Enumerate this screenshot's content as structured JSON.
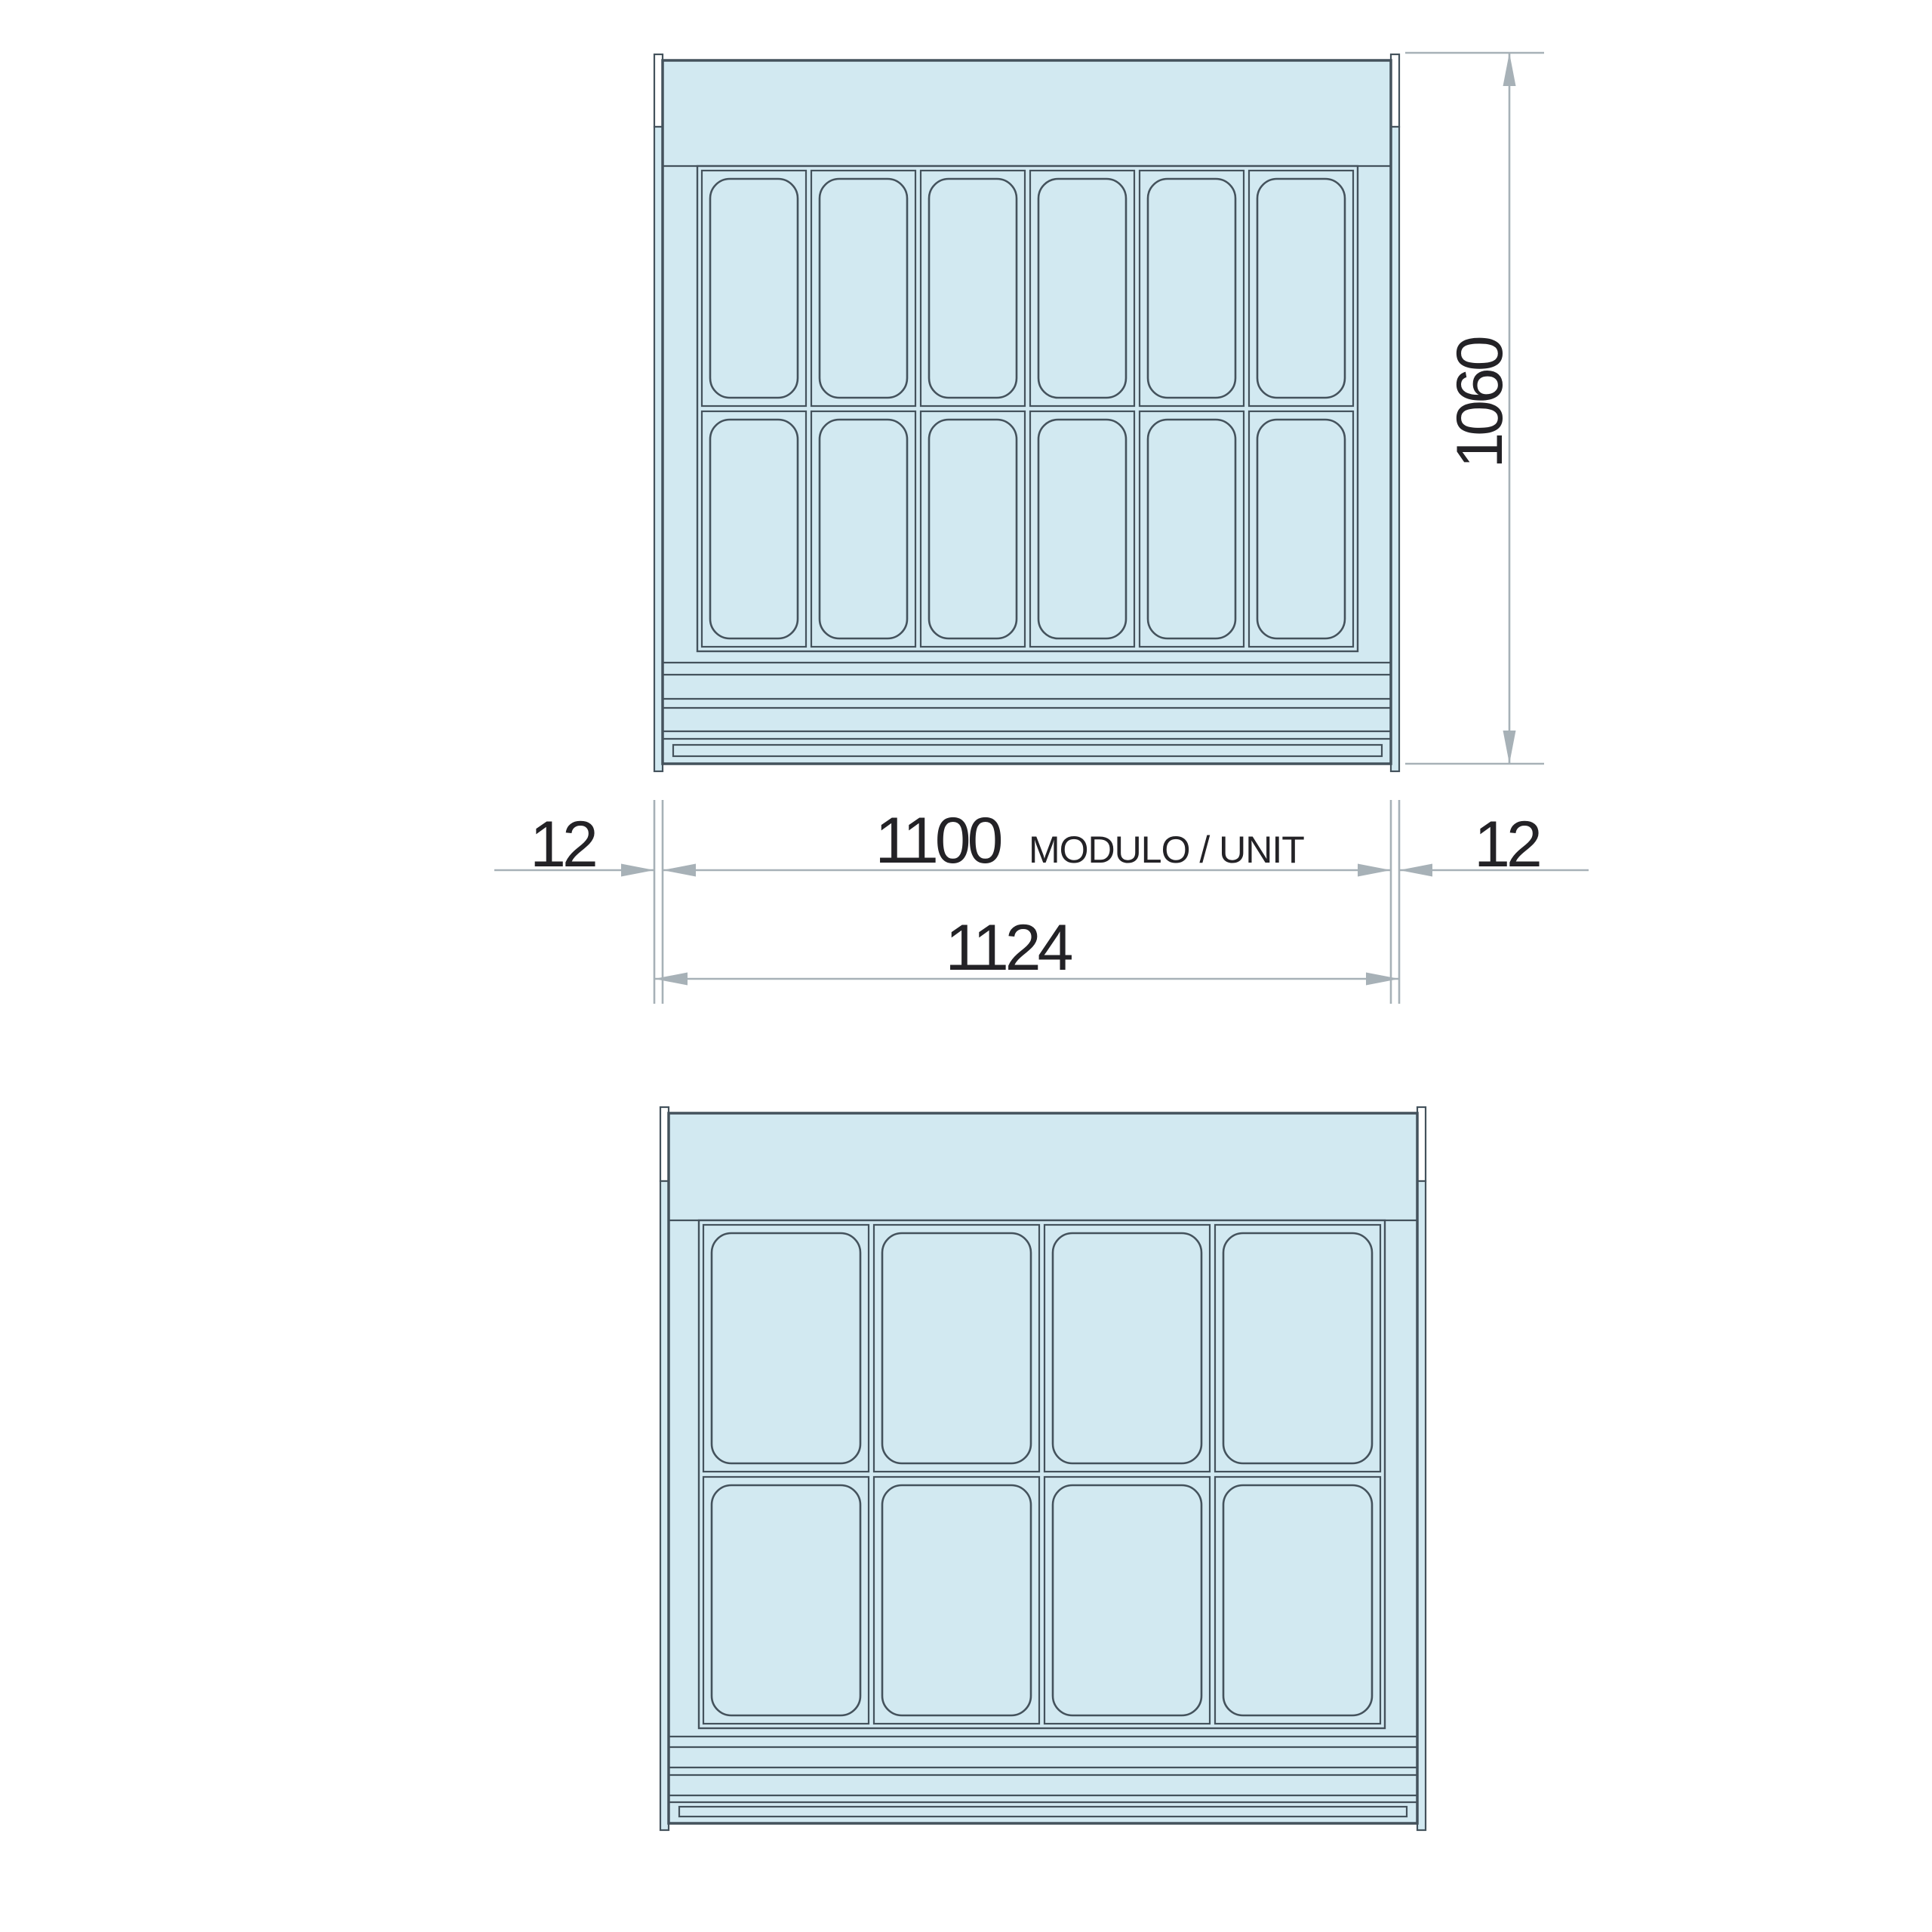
{
  "drawing": {
    "kind": "dimensioned-technical-drawing",
    "views": [
      {
        "id": "unit-top",
        "pans": {
          "cols": 6,
          "rows": 2,
          "count": 12
        }
      },
      {
        "id": "unit-bottom",
        "pans": {
          "cols": 4,
          "rows": 2,
          "count": 8
        }
      }
    ],
    "dimensions": {
      "height": "1060",
      "side_left": "12",
      "module": "1100",
      "module_note": "MODULO / UNIT",
      "side_right": "12",
      "overall_width": "1124"
    },
    "colors": {
      "fill": "#d2e9f1",
      "line": "#44525c",
      "dim": "#a7b1b7",
      "text": "#232226",
      "panel": "#ffffff",
      "background": "#ffffff"
    }
  }
}
